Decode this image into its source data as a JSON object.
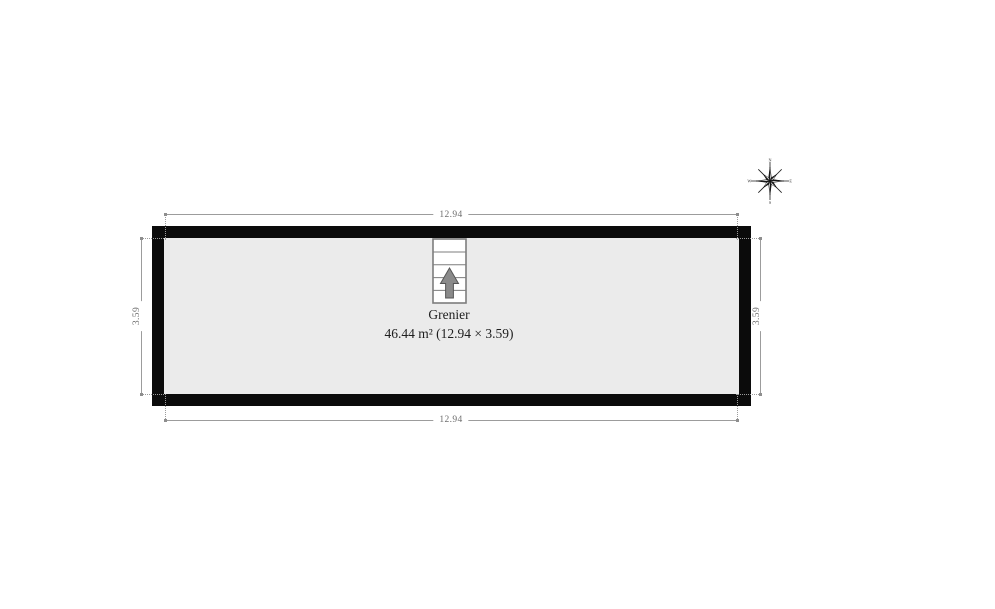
{
  "room": {
    "name": "Grenier",
    "area_label": "46.44 m² (12.94 × 3.59)"
  },
  "dimensions": {
    "top": "12.94",
    "bottom": "12.94",
    "left": "3.59",
    "right": "3.59"
  },
  "compass": {
    "points": [
      "N",
      "E",
      "S",
      "W"
    ]
  },
  "icons": {
    "stairs": "stairs-with-up-arrow",
    "compass": "compass-rose"
  },
  "colors": {
    "background": "#ffffff",
    "wall": "#0b0b0b",
    "floor": "#ebebeb",
    "dimension_line": "#9c9c9c",
    "dimension_text": "#6e6e6e",
    "label_text": "#1e1e1e",
    "stairs_outline": "#7d7d7d",
    "stairs_arrow": "#8a8a8a"
  }
}
